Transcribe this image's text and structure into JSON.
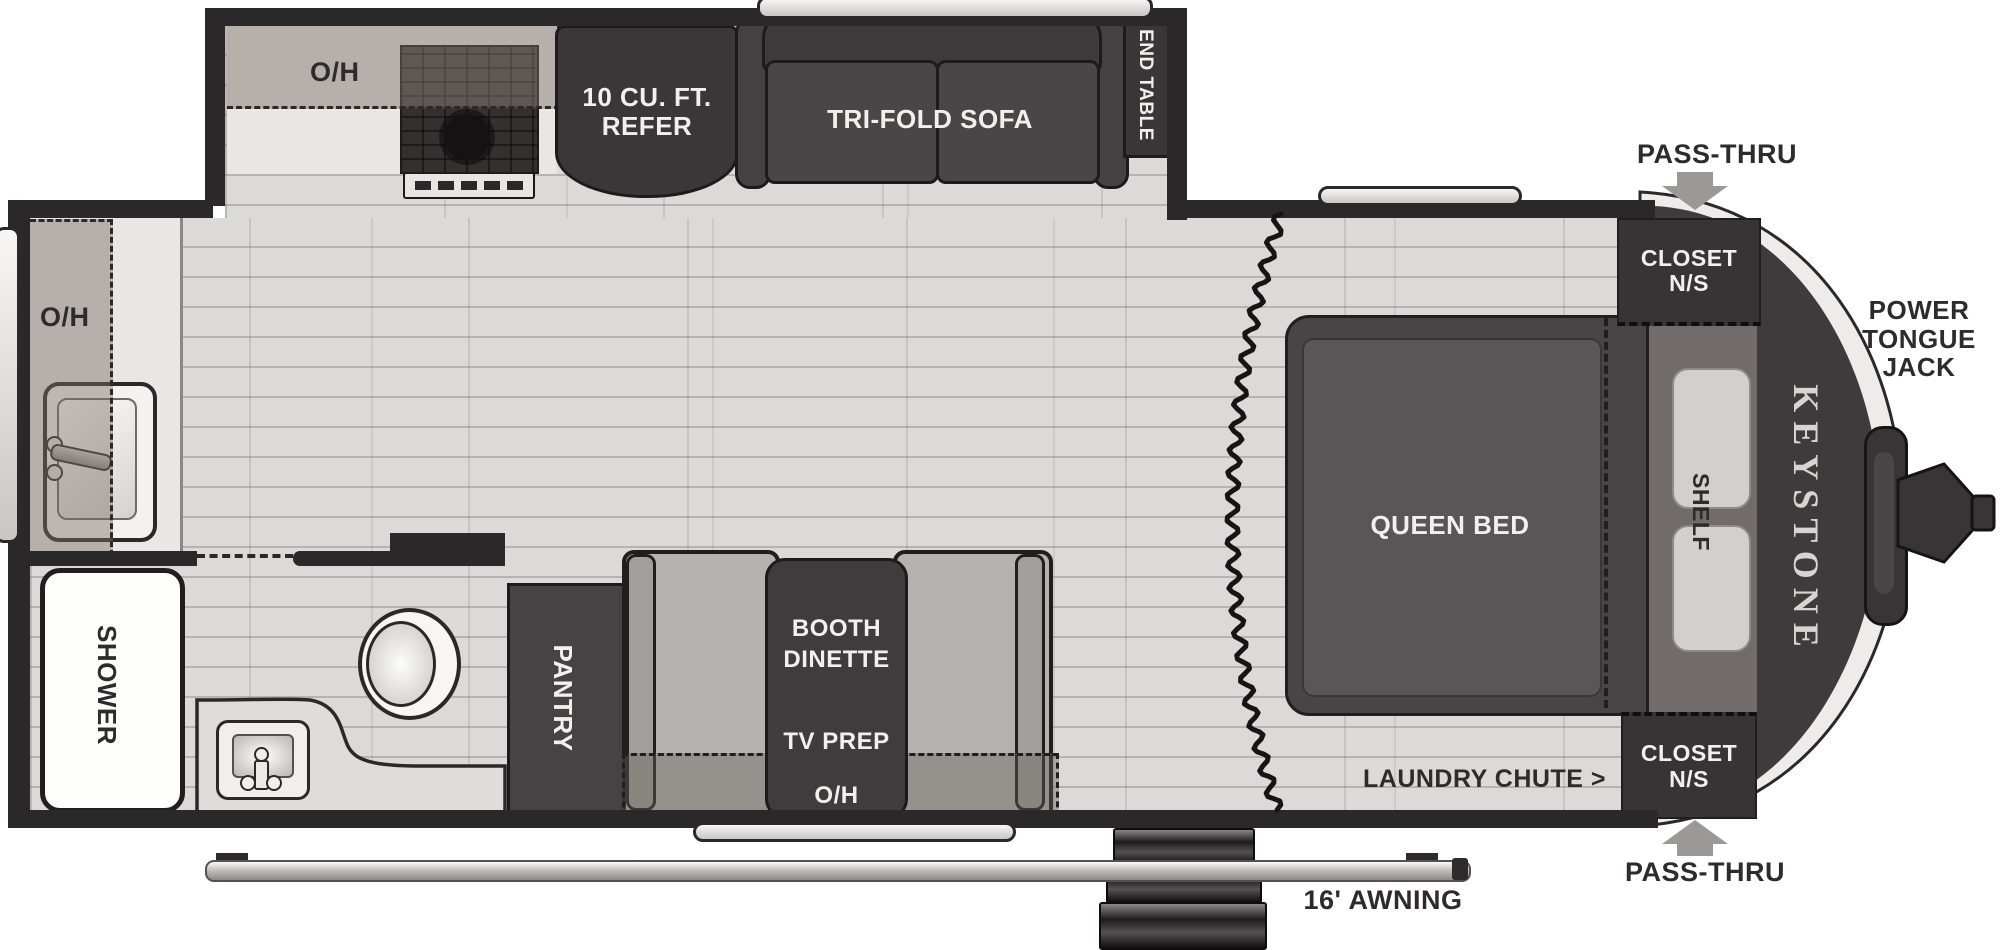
{
  "floorplan": {
    "brand": "KEYSTONE",
    "slideout": {
      "overhead_label": "O/H",
      "refrigerator_line1": "10 CU. FT.",
      "refrigerator_line2": "REFER",
      "sofa_label": "TRI-FOLD SOFA",
      "end_table_label": "END TABLE"
    },
    "rear_kitchen": {
      "overhead_label": "O/H"
    },
    "bathroom": {
      "shower_label": "SHOWER"
    },
    "dinette": {
      "pantry_label": "PANTRY",
      "table_line1": "BOOTH",
      "table_line2": "DINETTE",
      "tv_prep_label": "TV PREP",
      "overhead_label": "O/H"
    },
    "bedroom": {
      "bed_label": "QUEEN BED",
      "shelf_label": "SHELF",
      "closet_top_line1": "CLOSET",
      "closet_top_line2": "N/S",
      "closet_bottom_line1": "CLOSET",
      "closet_bottom_line2": "N/S",
      "laundry_chute_label": "LAUNDRY CHUTE >"
    },
    "exterior": {
      "pass_thru_top_label": "PASS-THRU",
      "pass_thru_bottom_label": "PASS-THRU",
      "power_tongue_jack_line1": "POWER",
      "power_tongue_jack_line2": "TONGUE",
      "power_tongue_jack_line3": "JACK",
      "awning_label": "16' AWNING"
    },
    "colors": {
      "wall": "#2b2829",
      "furniture_dark": "#403c3e",
      "floor": "#dbdad9",
      "counter_light": "#e9e6e3",
      "arrow_gray": "#9b9896"
    }
  }
}
